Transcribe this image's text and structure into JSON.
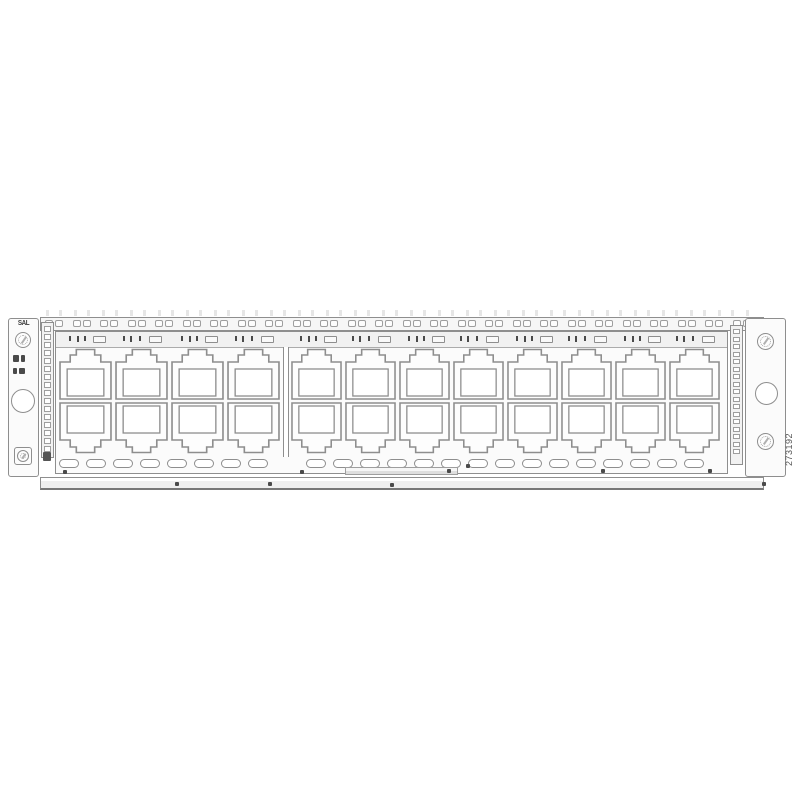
{
  "figure": {
    "bracket_label": "SAL",
    "figure_number": "273192"
  },
  "colors": {
    "background": "#ffffff",
    "line": "#8e8e8e",
    "dark_marks": "#4a4a4a",
    "fill": "#fbfbfb"
  },
  "structure": {
    "port_rows": 2,
    "port_groups": [
      {
        "columns": 4
      },
      {
        "columns": 8
      }
    ],
    "total_ports": 24,
    "top_rail_slots": 26,
    "led_strip_cells": 16,
    "hole_strip_cells": 17,
    "label_strip_windows": 12,
    "vent_groups": [
      {
        "count": 8
      },
      {
        "count": 15
      }
    ]
  }
}
